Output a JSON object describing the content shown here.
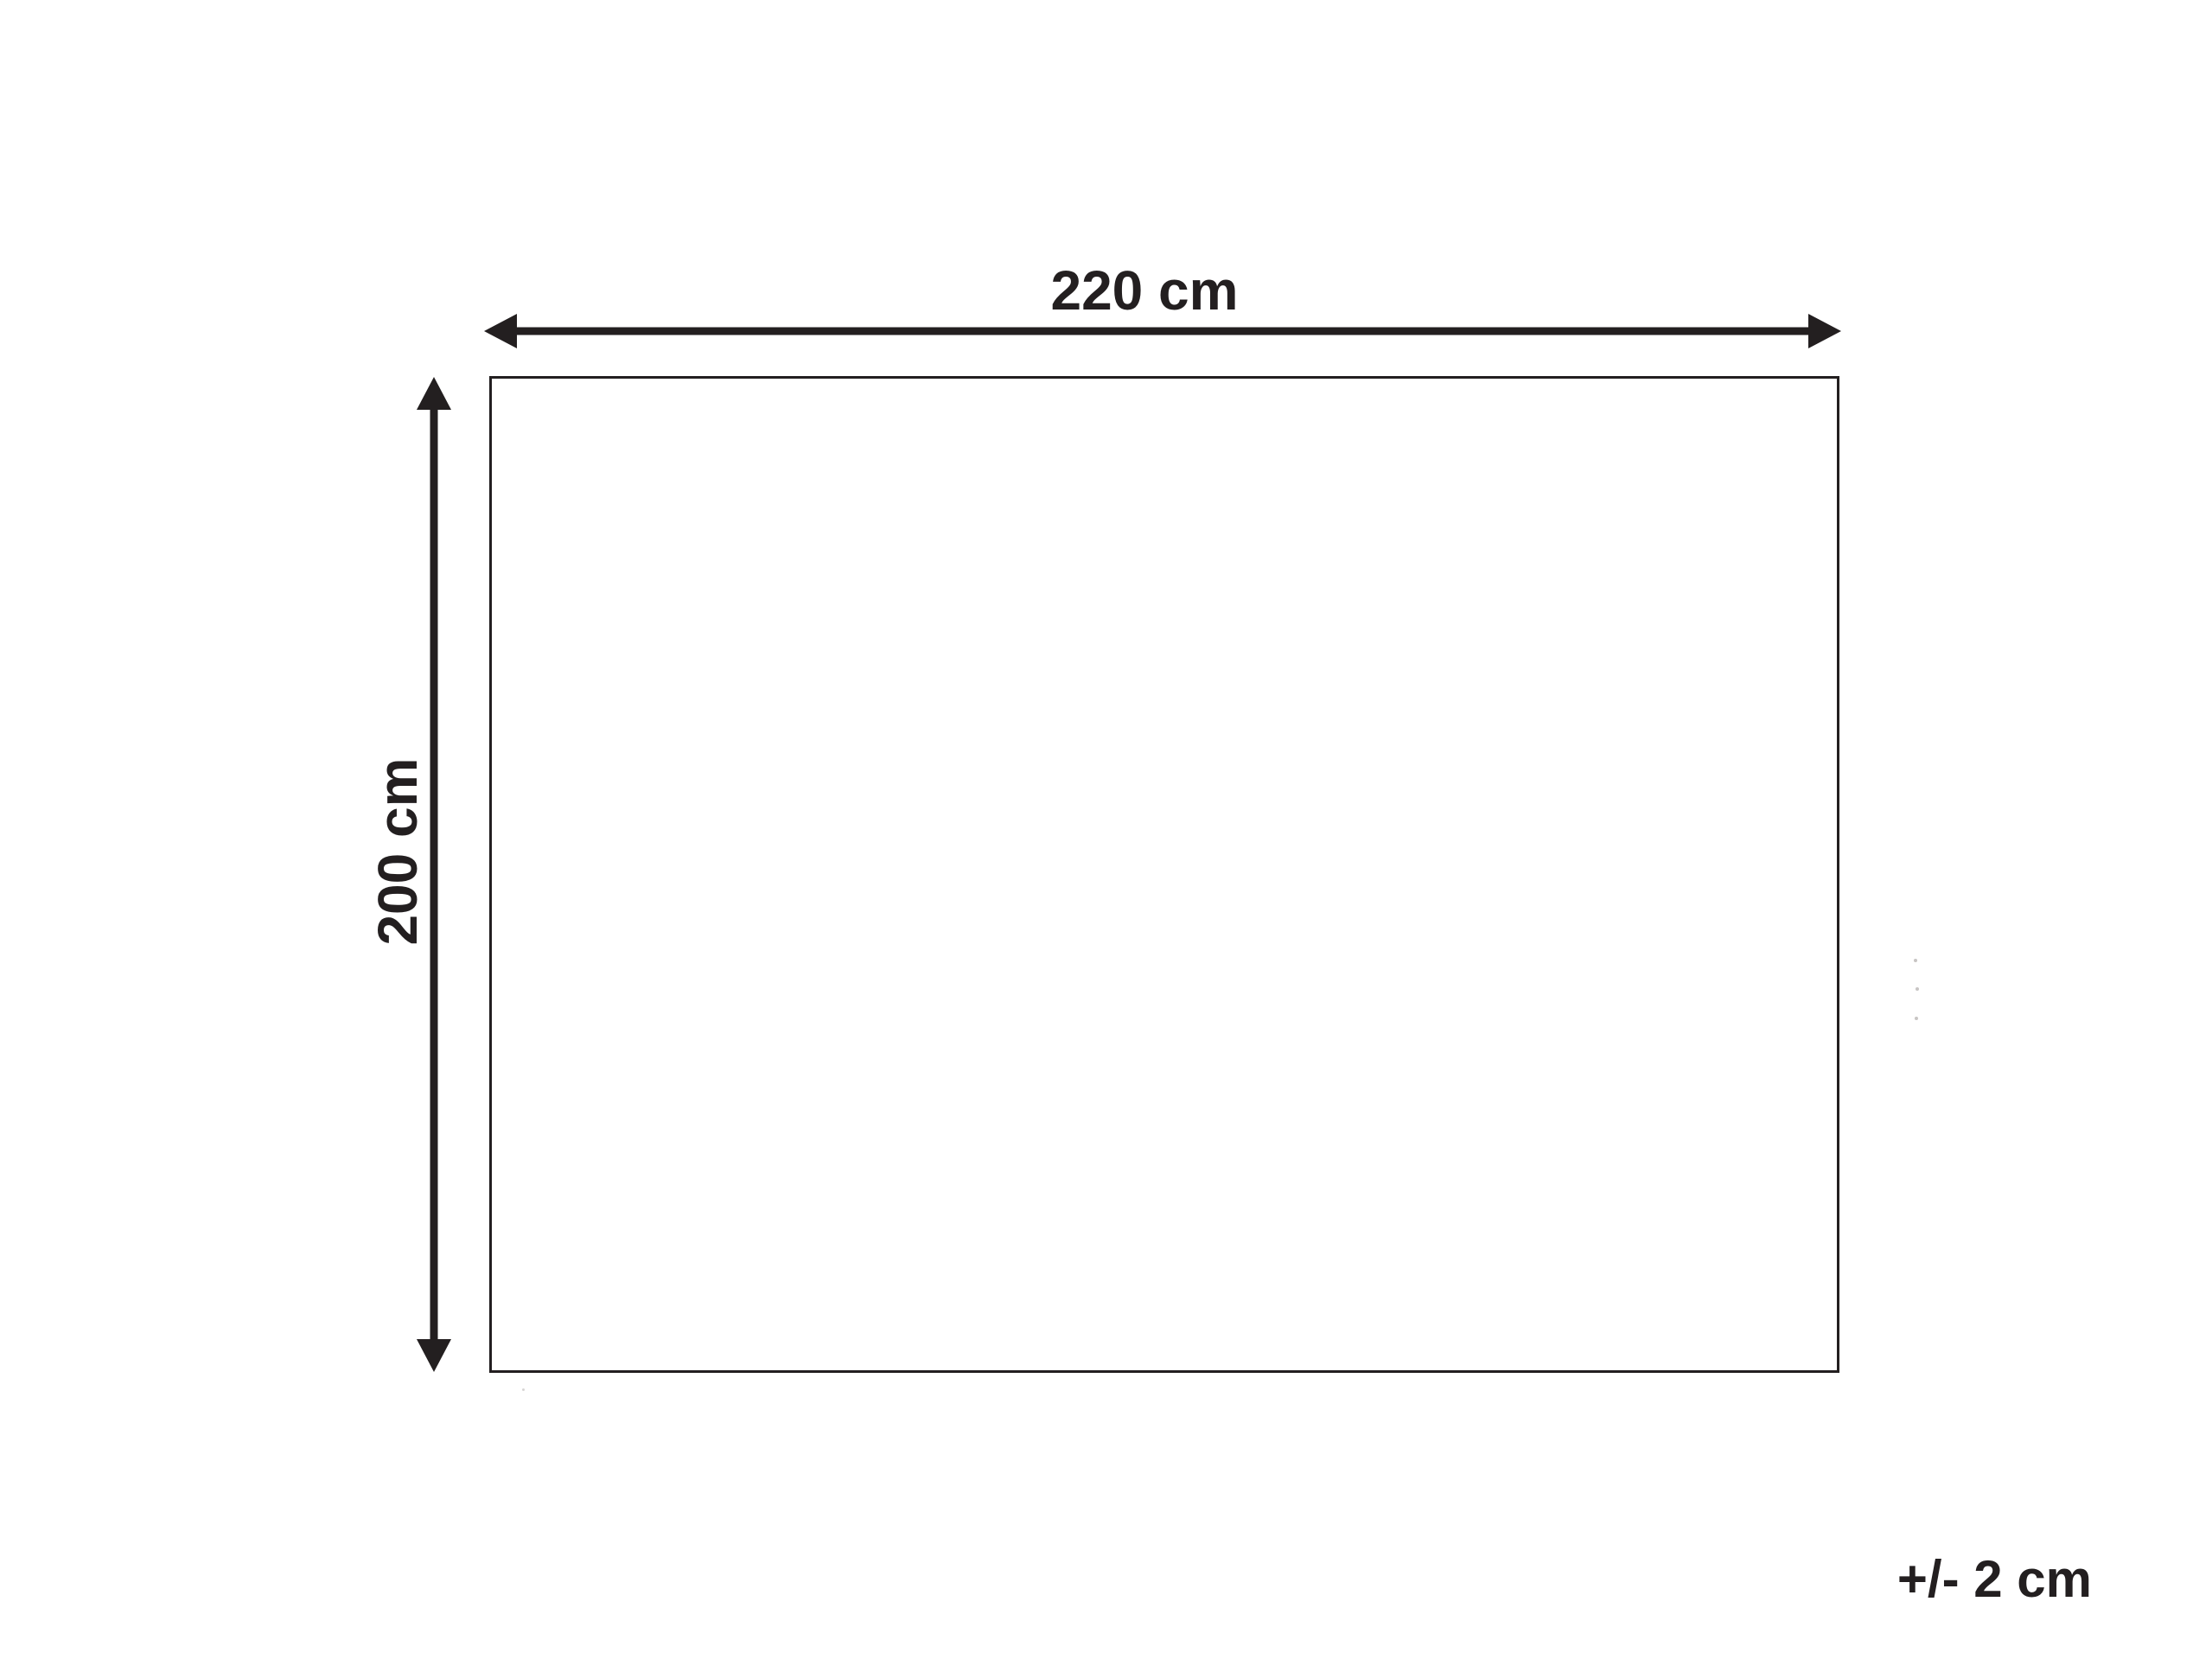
{
  "diagram": {
    "kind": "product-dimension-diagram",
    "background_color": "#ffffff",
    "line_color": "#231f20",
    "width_label": "220 cm",
    "height_label": "200 cm",
    "tolerance_label": "+/- 2 cm"
  }
}
